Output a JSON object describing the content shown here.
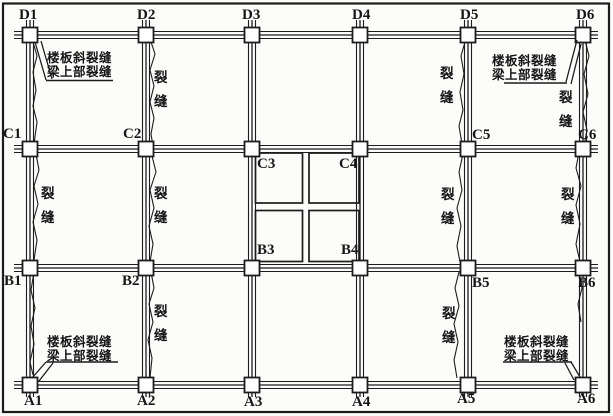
{
  "figure": {
    "type": "structural-crack-plan",
    "colors": {
      "background": "#fcfcfb",
      "line": "#1c1c1c",
      "column_fill": "#ffffff",
      "text": "#161616"
    },
    "grid": {
      "column_lines_x": [
        30,
        146,
        252,
        360,
        468,
        583
      ],
      "row_lines_y": [
        35,
        149,
        268,
        385
      ],
      "beam_x_extent": [
        14,
        598
      ],
      "beam_y_extent": [
        20,
        397
      ],
      "beam_line_spread": 3.5,
      "column_size": 15,
      "border_rect": [
        3,
        3.5,
        606,
        408.5
      ]
    },
    "node_labels": [
      {
        "text": "D1",
        "x": 19,
        "y": 8
      },
      {
        "text": "D2",
        "x": 137,
        "y": 8
      },
      {
        "text": "D3",
        "x": 242,
        "y": 8
      },
      {
        "text": "D4",
        "x": 352,
        "y": 8
      },
      {
        "text": "D5",
        "x": 460,
        "y": 8
      },
      {
        "text": "D6",
        "x": 576,
        "y": 8
      },
      {
        "text": "C1",
        "x": 3,
        "y": 127
      },
      {
        "text": "C2",
        "x": 123,
        "y": 127
      },
      {
        "text": "C3",
        "x": 257,
        "y": 157
      },
      {
        "text": "C4",
        "x": 339,
        "y": 157
      },
      {
        "text": "C5",
        "x": 472,
        "y": 128
      },
      {
        "text": "C6",
        "x": 578,
        "y": 128
      },
      {
        "text": "B1",
        "x": 4,
        "y": 274
      },
      {
        "text": "B2",
        "x": 122,
        "y": 274
      },
      {
        "text": "B3",
        "x": 257,
        "y": 243
      },
      {
        "text": "B4",
        "x": 341,
        "y": 243
      },
      {
        "text": "B5",
        "x": 472,
        "y": 276
      },
      {
        "text": "B6",
        "x": 578,
        "y": 276
      },
      {
        "text": "A1",
        "x": 24,
        "y": 394
      },
      {
        "text": "A2",
        "x": 137,
        "y": 394
      },
      {
        "text": "A3",
        "x": 244,
        "y": 395
      },
      {
        "text": "A4",
        "x": 352,
        "y": 395
      },
      {
        "text": "A5",
        "x": 457,
        "y": 392
      },
      {
        "text": "A6",
        "x": 577,
        "y": 392
      }
    ],
    "stair_opening": {
      "quadrants": [
        [
          255.5,
          153,
          47,
          50
        ],
        [
          309,
          153,
          50,
          50
        ],
        [
          255.5,
          210.5,
          47,
          51
        ],
        [
          309,
          210.5,
          50,
          51
        ]
      ]
    },
    "crack_label_text": "裂缝",
    "vertical_crack_labels": [
      {
        "x": 154,
        "y": 71
      },
      {
        "x": 440,
        "y": 67
      },
      {
        "x": 559,
        "y": 91
      },
      {
        "x": 41,
        "y": 187
      },
      {
        "x": 154,
        "y": 187
      },
      {
        "x": 441,
        "y": 188
      },
      {
        "x": 561,
        "y": 188
      },
      {
        "x": 154,
        "y": 305
      },
      {
        "x": 442,
        "y": 307
      }
    ],
    "corner_notes": [
      {
        "id": "top-left",
        "line1": "楼板斜裂缝",
        "line2": "梁上部裂缝",
        "x": 47,
        "y": 51,
        "underline": [
          46,
          113,
          80.5
        ],
        "leaders": [
          [
            [
              35,
              42
            ],
            [
              46,
              80
            ]
          ],
          [
            [
              41,
              41
            ],
            [
              52,
              79
            ]
          ]
        ]
      },
      {
        "id": "top-right",
        "line1": "楼板斜裂缝",
        "line2": "梁上部裂缝",
        "x": 492,
        "y": 54,
        "underline": [
          504,
          567,
          83
        ],
        "leaders": [
          [
            [
              566,
              82
            ],
            [
              577,
              40
            ]
          ],
          [
            [
              571,
              84
            ],
            [
              581,
              44
            ]
          ]
        ]
      },
      {
        "id": "bottom-left",
        "line1": "楼板斜裂缝",
        "line2": "梁上部裂缝",
        "x": 47,
        "y": 335,
        "underline": [
          46,
          118,
          362
        ],
        "leaders": [
          [
            [
              46,
              362
            ],
            [
              32,
              378
            ]
          ],
          [
            [
              53,
              363
            ],
            [
              39,
              381
            ]
          ]
        ]
      },
      {
        "id": "bottom-right",
        "line1": "楼板斜裂缝",
        "line2": "梁上部裂缝",
        "x": 504,
        "y": 335,
        "underline": [
          503,
          572,
          362
        ],
        "leaders": [
          [
            [
              571,
              362
            ],
            [
              580,
              377
            ]
          ],
          [
            [
              565,
              363
            ],
            [
              574,
              380
            ]
          ]
        ]
      }
    ],
    "cracks": [
      [
        [
          33,
          42
        ],
        [
          37,
          56
        ],
        [
          33,
          72
        ],
        [
          36,
          90
        ],
        [
          33,
          106
        ],
        [
          37,
          122
        ],
        [
          34,
          144
        ]
      ],
      [
        [
          151,
          42
        ],
        [
          155,
          54
        ],
        [
          150,
          70
        ],
        [
          154,
          86
        ],
        [
          150,
          102
        ],
        [
          154,
          118
        ],
        [
          151,
          134
        ],
        [
          153,
          146
        ]
      ],
      [
        [
          465,
          42
        ],
        [
          461,
          56
        ],
        [
          464,
          74
        ],
        [
          460,
          92
        ],
        [
          463,
          110
        ],
        [
          459,
          126
        ],
        [
          462,
          144
        ]
      ],
      [
        [
          585,
          40
        ],
        [
          589,
          56
        ],
        [
          584,
          74
        ],
        [
          588,
          94
        ],
        [
          583,
          112
        ],
        [
          587,
          130
        ],
        [
          584,
          146
        ]
      ],
      [
        [
          36,
          154
        ],
        [
          39,
          170
        ],
        [
          34,
          186
        ],
        [
          38,
          204
        ],
        [
          33,
          222
        ],
        [
          37,
          240
        ],
        [
          34,
          260
        ]
      ],
      [
        [
          152,
          156
        ],
        [
          156,
          172
        ],
        [
          150,
          190
        ],
        [
          154,
          208
        ],
        [
          149,
          226
        ],
        [
          153,
          244
        ],
        [
          150,
          262
        ]
      ],
      [
        [
          463,
          154
        ],
        [
          459,
          172
        ],
        [
          462,
          190
        ],
        [
          457,
          208
        ],
        [
          461,
          226
        ],
        [
          457,
          246
        ],
        [
          460,
          262
        ]
      ],
      [
        [
          579,
          152
        ],
        [
          576,
          168
        ],
        [
          581,
          186
        ],
        [
          576,
          205
        ],
        [
          580,
          224
        ],
        [
          576,
          244
        ],
        [
          580,
          262
        ]
      ],
      [
        [
          151,
          272
        ],
        [
          154,
          288
        ],
        [
          149,
          304
        ],
        [
          153,
          322
        ],
        [
          148,
          340
        ],
        [
          152,
          358
        ],
        [
          150,
          378
        ]
      ],
      [
        [
          459,
          272
        ],
        [
          455,
          288
        ],
        [
          459,
          306
        ],
        [
          454,
          324
        ],
        [
          458,
          342
        ],
        [
          454,
          360
        ],
        [
          457,
          378
        ]
      ],
      [
        [
          34,
          272
        ],
        [
          31,
          290
        ],
        [
          35,
          308
        ],
        [
          31,
          326
        ],
        [
          34,
          344
        ],
        [
          30,
          362
        ],
        [
          33,
          375
        ]
      ],
      [
        [
          579,
          272
        ],
        [
          582,
          288
        ],
        [
          578,
          304
        ],
        [
          581,
          322
        ]
      ]
    ]
  }
}
